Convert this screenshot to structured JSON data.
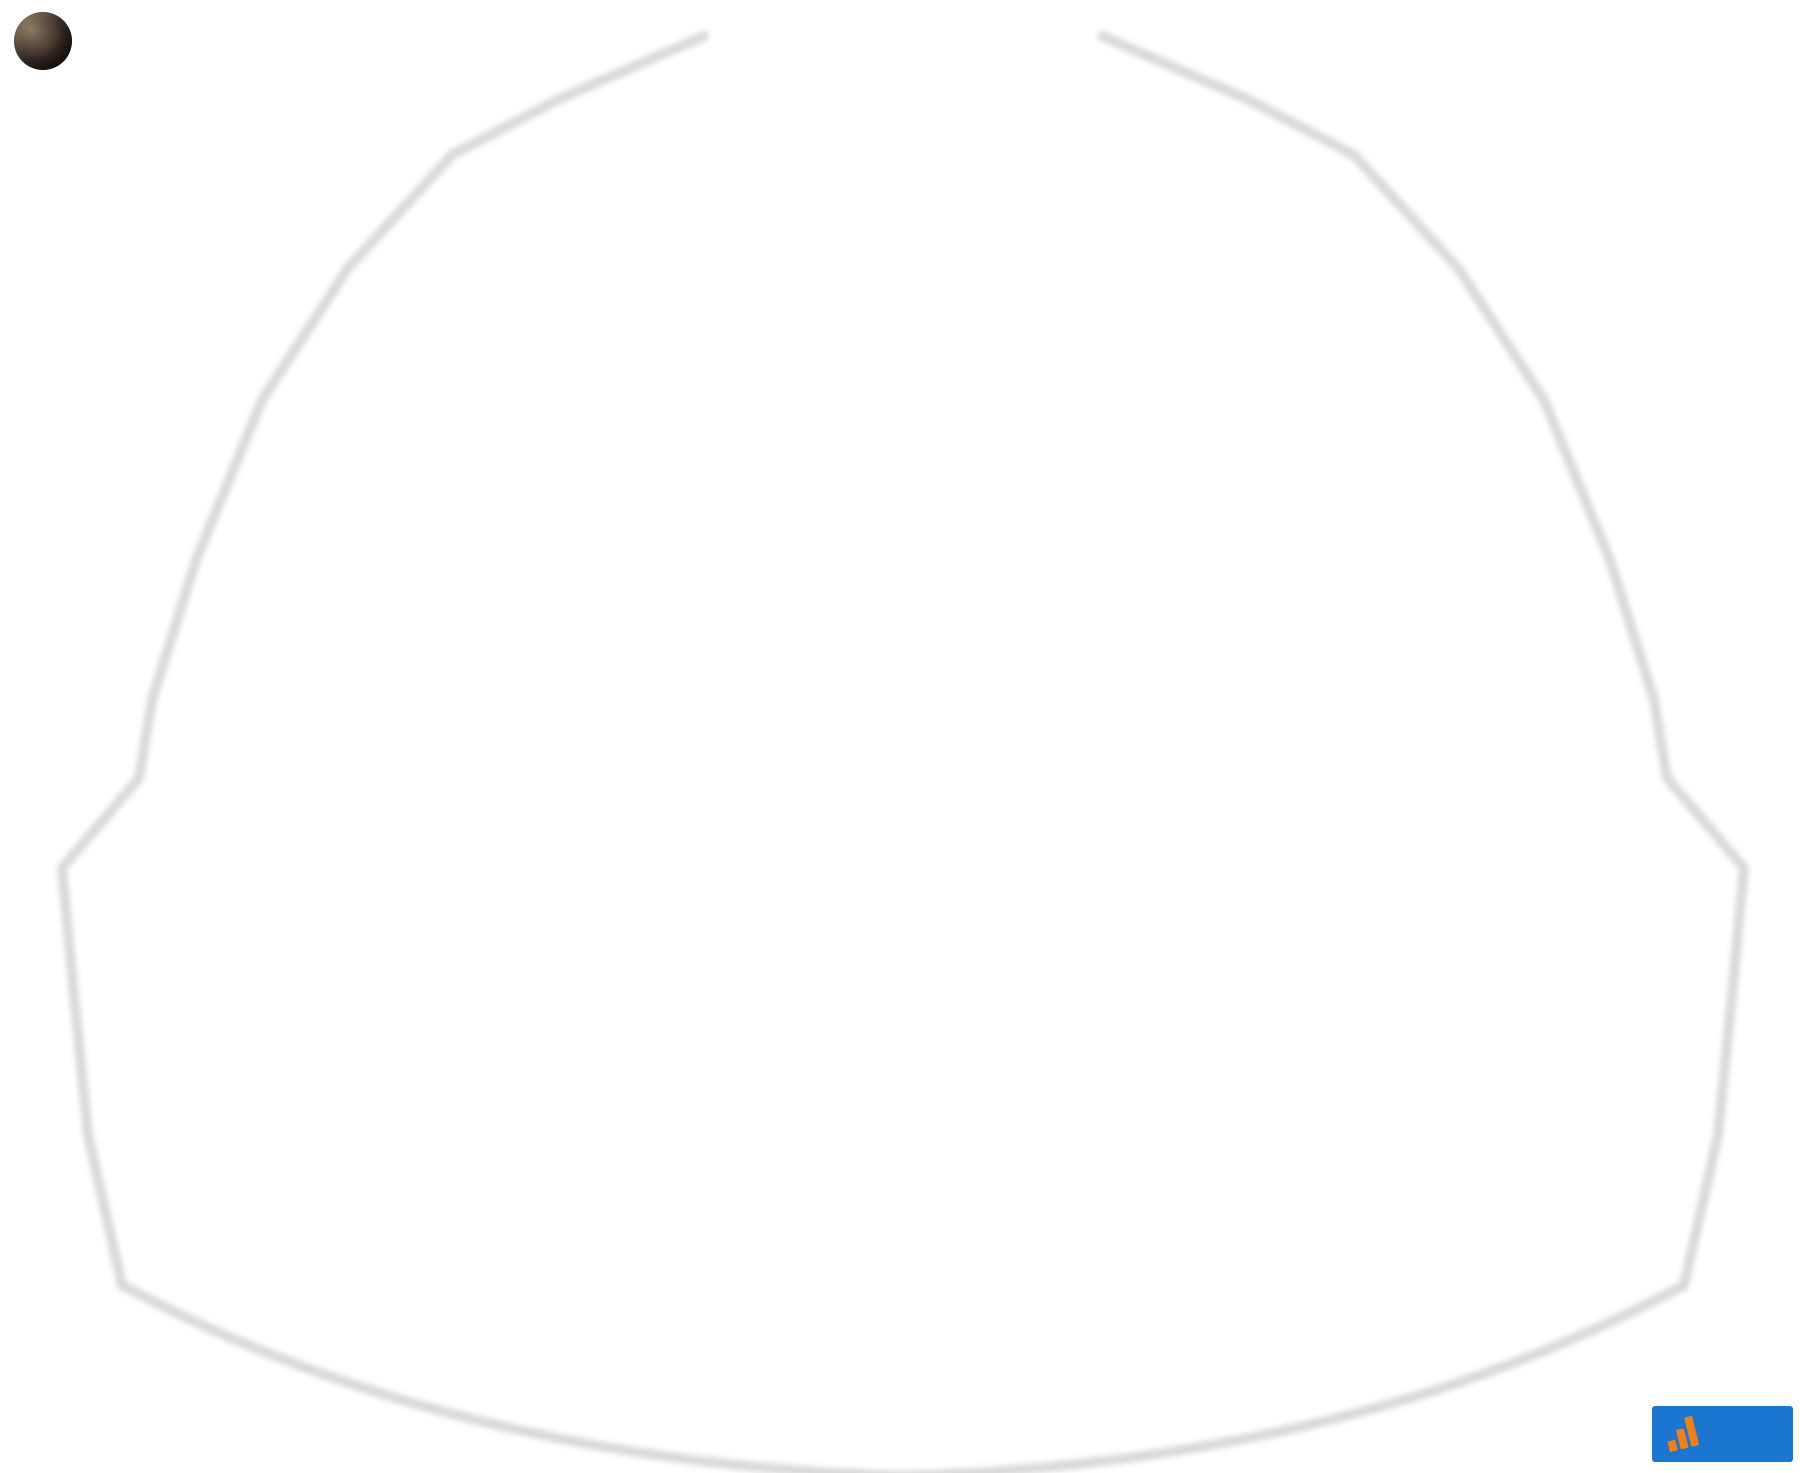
{
  "header": {
    "title": "Lady A Seating Chart",
    "subtitle": "Texas Trust CU Theatre - December 10, 2025 at 7:00 PM"
  },
  "stage": {
    "label": "STAGE"
  },
  "bands": {
    "100s": [
      "105",
      "104",
      "103",
      "102",
      "101"
    ],
    "200s": [
      "207",
      "206",
      "205",
      "204",
      "203",
      "202",
      "201"
    ],
    "300s": [
      "309",
      "308",
      "307",
      "306",
      "305",
      "304",
      "303",
      "302",
      "301"
    ],
    "400s": [
      "413",
      "412",
      "411",
      "410",
      "409",
      "408",
      "407",
      "406",
      "405",
      "404",
      "403",
      "402",
      "401"
    ]
  },
  "premium": {
    "club": "Club",
    "boxes": [
      "1",
      "2",
      "3",
      "4",
      "5",
      "6",
      "7",
      "8",
      "9",
      "10",
      "11",
      "12",
      "13",
      "14",
      "15",
      "16"
    ],
    "super": "Super"
  },
  "kings_row": {
    "label": "Kings Row"
  },
  "footer": {
    "site": "RateYourSeats.com",
    "updated": "Last Updated: September 12, 2025"
  },
  "logo": {
    "top": "RATEYOUR",
    "main": "SEATS",
    "tld": ".com"
  },
  "colors": {
    "section_blue": "#1164c9",
    "section_border": "#555555",
    "stage_bg": "#000000",
    "outline_gray": "#d7d7d7",
    "logo_blue": "#1b76d2",
    "logo_orange": "#f57f17",
    "footer_text": "#8d8d8d"
  }
}
